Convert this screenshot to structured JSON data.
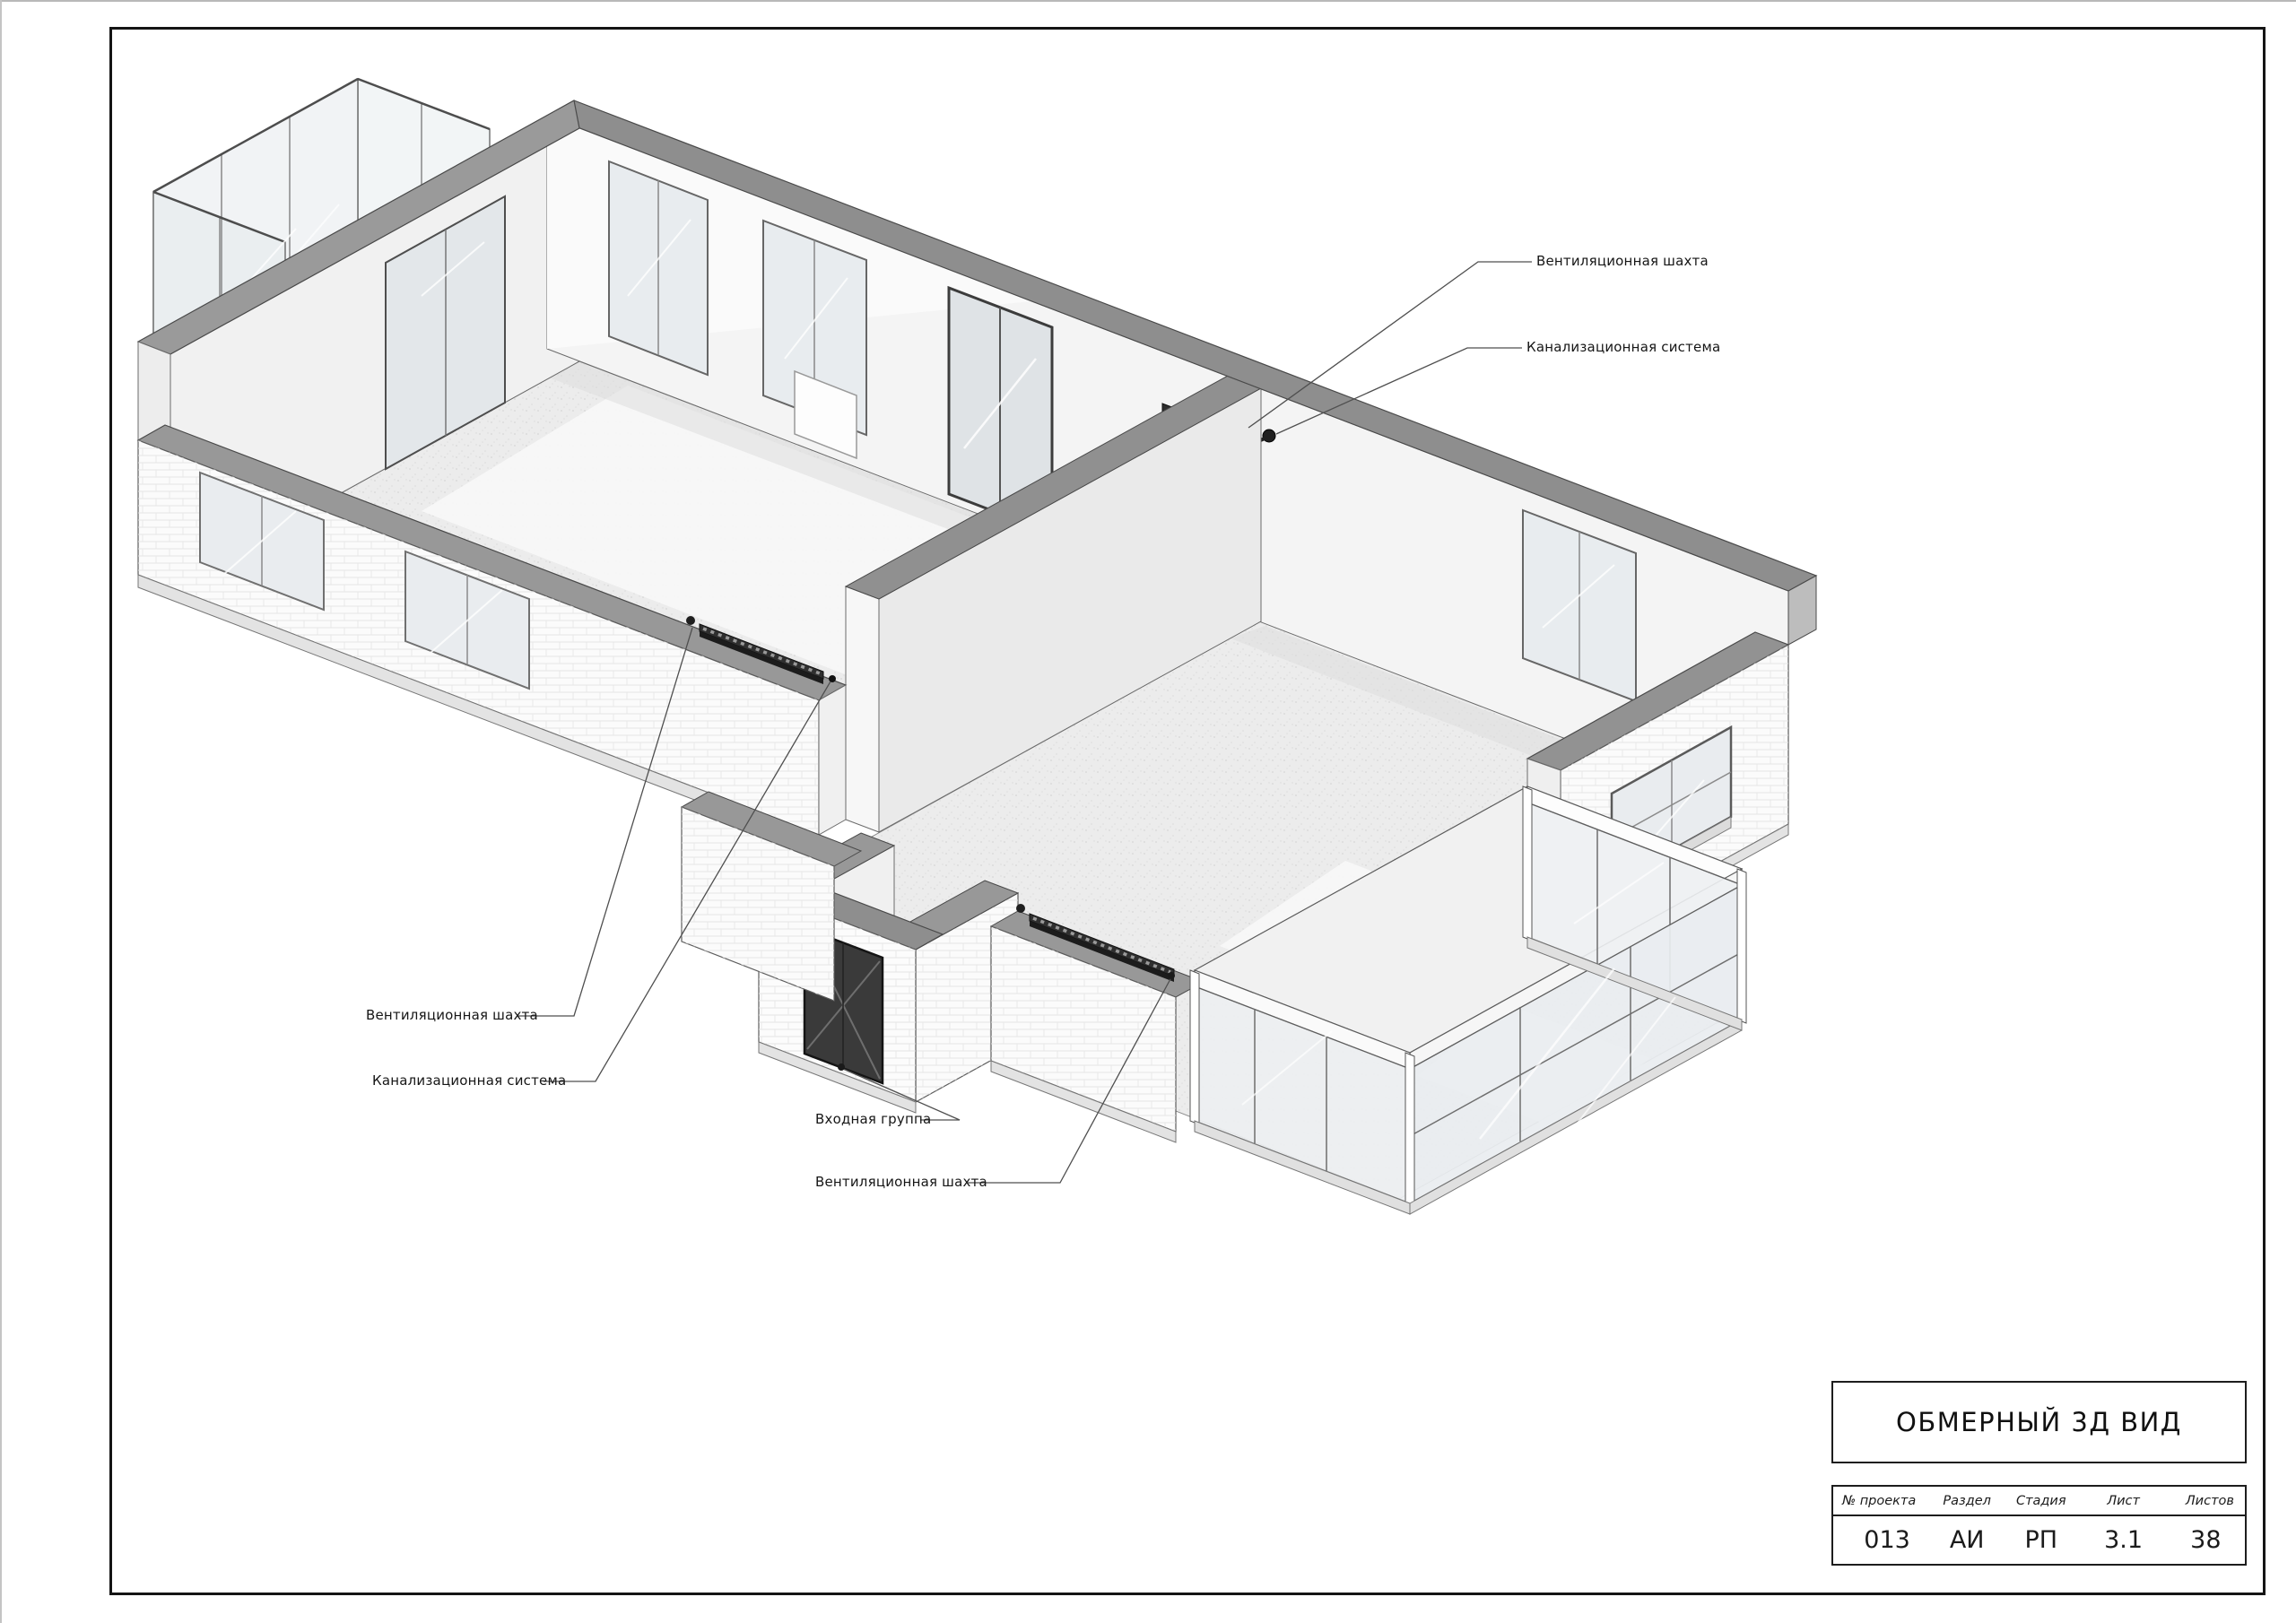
{
  "sheet": {
    "background": "#ffffff",
    "frame_color": "#141414"
  },
  "callouts": [
    {
      "id": "vent-shaft-top-right",
      "label": "Вентиляционная шахта"
    },
    {
      "id": "sewer-system-top-right",
      "label": "Канализационная система"
    },
    {
      "id": "vent-shaft-left",
      "label": "Вентиляционная шахта"
    },
    {
      "id": "sewer-system-left",
      "label": "Канализационная система"
    },
    {
      "id": "entrance-group",
      "label": "Входная группа"
    },
    {
      "id": "vent-shaft-bottom",
      "label": "Вентиляционная шахта"
    }
  ],
  "title_block": {
    "title": "ОБМЕРНЫЙ 3Д ВИД",
    "columns": [
      {
        "label": "№ проекта",
        "value": "013"
      },
      {
        "label": "Раздел",
        "value": "АИ"
      },
      {
        "label": "Стадия",
        "value": "РП"
      },
      {
        "label": "Лист",
        "value": "3.1"
      },
      {
        "label": "Листов",
        "value": "38"
      }
    ]
  },
  "colors": {
    "wall_top": "#8e8e8e",
    "wall_interior": "#f4f4f4",
    "brick_wall": "#fbfbfb",
    "floor": "#ececec",
    "glass": "#edf0f2",
    "radiator": "#2e2e2e",
    "entrance_door": "#3a3a3a",
    "leader_line": "#4f4f4f"
  }
}
